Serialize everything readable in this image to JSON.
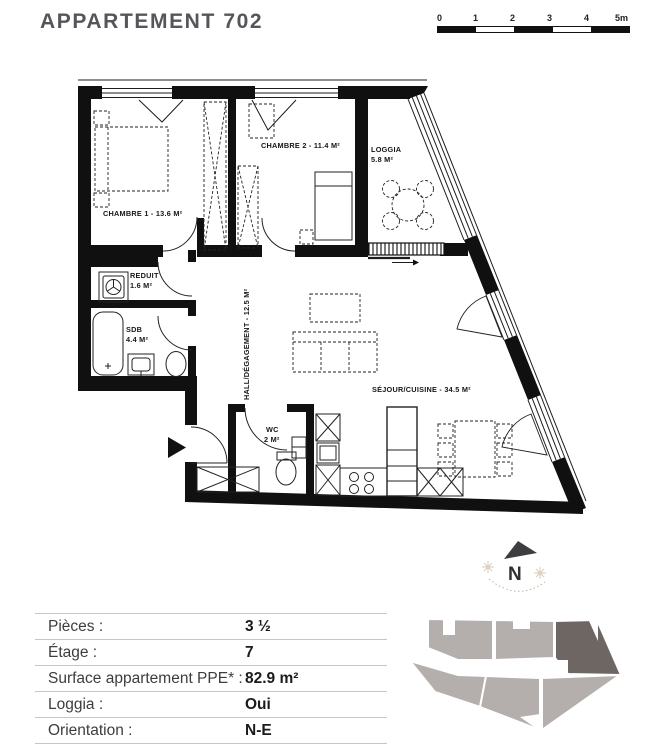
{
  "title": "APPARTEMENT 702",
  "scale_bar": {
    "ticks": [
      "0",
      "1",
      "2",
      "3",
      "4",
      "5m"
    ]
  },
  "floor_plan": {
    "rooms": {
      "chambre1": "CHAMBRE 1 - 13.6 M²",
      "chambre2": "CHAMBRE 2 - 11.4 M²",
      "loggia_name": "LOGGIA",
      "loggia_area": "5.8 M²",
      "reduit_name": "REDUIT",
      "reduit_area": "1.6 M²",
      "sdb_name": "SDB",
      "sdb_area": "4.4 M²",
      "wc_name": "WC",
      "wc_area": "2 M²",
      "hall": "HALL/DÉGAGEMENT - 12.5 M²",
      "sejour": "SÉJOUR/CUISINE - 34.5 M²"
    }
  },
  "compass": {
    "north_label": "N"
  },
  "details_table": {
    "rows": [
      {
        "label": "Pièces :",
        "value": "3 ½"
      },
      {
        "label": "Étage :",
        "value": "7"
      },
      {
        "label": "Surface appartement PPE* :",
        "value": "82.9 m²"
      },
      {
        "label": "Loggia :",
        "value": "Oui"
      },
      {
        "label": "Orientation :",
        "value": "N-E"
      }
    ]
  },
  "footprint": {
    "highlighted_unit": "702"
  },
  "colors": {
    "title_gray": "#55565a",
    "unit_light": "#b4afac",
    "unit_dark": "#6e6662",
    "compass_sun": "#ddd3c0"
  }
}
